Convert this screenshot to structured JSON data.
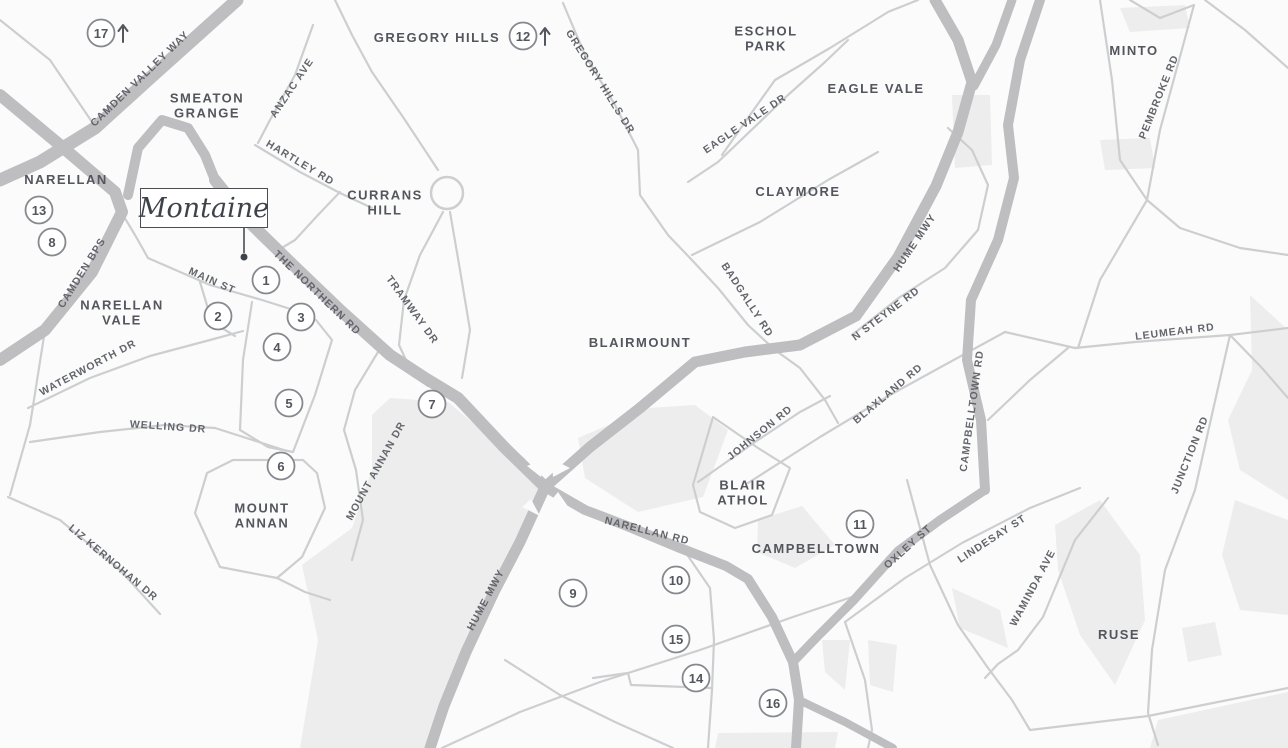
{
  "colors": {
    "bg": "#fbfbfb",
    "area": "#ededee",
    "road_thin": "#cdced0",
    "road_thick": "#bebec1",
    "suburb_label": "#54565e",
    "road_label": "#63656c",
    "marker_stroke": "#86888e",
    "marker_text": "#54565e",
    "montaine_border": "#4a4d54",
    "montaine_text": "#3e424b"
  },
  "montaine": {
    "label": "Montaine",
    "box": {
      "x": 140,
      "y": 188,
      "w": 128,
      "h": 40
    },
    "leader": {
      "x1": 244,
      "y1": 228,
      "x2": 244,
      "y2": 253
    },
    "dot": {
      "x": 244,
      "y": 257
    }
  },
  "suburbs": [
    {
      "name": "gregory-hills",
      "lines": [
        "GREGORY HILLS"
      ],
      "x": 437,
      "y": 42
    },
    {
      "name": "smeaton-grange",
      "lines": [
        "SMEATON",
        "GRANGE"
      ],
      "x": 207,
      "y": 110
    },
    {
      "name": "narellan",
      "lines": [
        "NARELLAN"
      ],
      "x": 66,
      "y": 184
    },
    {
      "name": "narellan-vale",
      "lines": [
        "NARELLAN",
        "VALE"
      ],
      "x": 122,
      "y": 317
    },
    {
      "name": "currans-hill",
      "lines": [
        "CURRANS",
        "HILL"
      ],
      "x": 385,
      "y": 207
    },
    {
      "name": "mount-annan",
      "lines": [
        "MOUNT",
        "ANNAN"
      ],
      "x": 262,
      "y": 520
    },
    {
      "name": "blairmount",
      "lines": [
        "BLAIRMOUNT"
      ],
      "x": 640,
      "y": 347
    },
    {
      "name": "eschol-park",
      "lines": [
        "ESCHOL",
        "PARK"
      ],
      "x": 766,
      "y": 43
    },
    {
      "name": "eagle-vale",
      "lines": [
        "EAGLE VALE"
      ],
      "x": 876,
      "y": 93
    },
    {
      "name": "claymore",
      "lines": [
        "CLAYMORE"
      ],
      "x": 798,
      "y": 196
    },
    {
      "name": "minto",
      "lines": [
        "MINTO"
      ],
      "x": 1134,
      "y": 55
    },
    {
      "name": "blair-athol",
      "lines": [
        "BLAIR",
        "ATHOL"
      ],
      "x": 743,
      "y": 497
    },
    {
      "name": "campbelltown",
      "lines": [
        "CAMPBELLTOWN"
      ],
      "x": 816,
      "y": 553
    },
    {
      "name": "ruse",
      "lines": [
        "RUSE"
      ],
      "x": 1119,
      "y": 639
    }
  ],
  "road_labels": [
    {
      "name": "camden-valley-way",
      "label": "CAMDEN VALLEY WAY",
      "x": 140,
      "y": 79,
      "rotate": -44
    },
    {
      "name": "camden-bps",
      "label": "CAMDEN BPS",
      "x": 82,
      "y": 273,
      "rotate": -58
    },
    {
      "name": "anzac-ave",
      "label": "ANZAC AVE",
      "x": 292,
      "y": 88,
      "rotate": -56
    },
    {
      "name": "hartley-rd",
      "label": "HARTLEY RD",
      "x": 300,
      "y": 163,
      "rotate": 31
    },
    {
      "name": "main-st",
      "label": "MAIN ST",
      "x": 212,
      "y": 281,
      "rotate": 24
    },
    {
      "name": "the-northern-rd",
      "label": "THE NORTHERN RD",
      "x": 317,
      "y": 293,
      "rotate": 44
    },
    {
      "name": "tramway-dr",
      "label": "TRAMWAY DR",
      "x": 412,
      "y": 310,
      "rotate": 54
    },
    {
      "name": "mount-annan-dr",
      "label": "MOUNT ANNAN DR",
      "x": 376,
      "y": 471,
      "rotate": -61
    },
    {
      "name": "waterworth-dr",
      "label": "WATERWORTH DR",
      "x": 88,
      "y": 368,
      "rotate": -28
    },
    {
      "name": "welling-dr",
      "label": "WELLING DR",
      "x": 168,
      "y": 427,
      "rotate": 4
    },
    {
      "name": "liz-kernohan-dr",
      "label": "LIZ KERNOHAN DR",
      "x": 113,
      "y": 563,
      "rotate": 40
    },
    {
      "name": "gregory-hills-dr",
      "label": "GREGORY HILLS DR",
      "x": 600,
      "y": 82,
      "rotate": 58
    },
    {
      "name": "eagle-vale-dr",
      "label": "EAGLE VALE DR",
      "x": 745,
      "y": 124,
      "rotate": -34
    },
    {
      "name": "hume-mwy-north",
      "label": "HUME MWY",
      "x": 915,
      "y": 243,
      "rotate": -56
    },
    {
      "name": "hume-mwy-south",
      "label": "HUME MWY",
      "x": 486,
      "y": 600,
      "rotate": -62
    },
    {
      "name": "pembroke-rd",
      "label": "PEMBROKE RD",
      "x": 1159,
      "y": 97,
      "rotate": -68
    },
    {
      "name": "badgally-rd",
      "label": "BADGALLY RD",
      "x": 747,
      "y": 300,
      "rotate": 57
    },
    {
      "name": "n-steyne-rd",
      "label": "N STEYNE RD",
      "x": 886,
      "y": 314,
      "rotate": -37
    },
    {
      "name": "blaxland-rd",
      "label": "BLAXLAND RD",
      "x": 888,
      "y": 394,
      "rotate": -40
    },
    {
      "name": "campbelltown-rd",
      "label": "CAMPBELLTOWN RD",
      "x": 972,
      "y": 411,
      "rotate": -82
    },
    {
      "name": "johnson-rd",
      "label": "JOHNSON RD",
      "x": 760,
      "y": 433,
      "rotate": -39
    },
    {
      "name": "narellan-rd",
      "label": "NARELLAN RD",
      "x": 647,
      "y": 531,
      "rotate": 14
    },
    {
      "name": "oxley-st",
      "label": "OXLEY ST",
      "x": 908,
      "y": 547,
      "rotate": -42
    },
    {
      "name": "lindesay-st",
      "label": "LINDESAY ST",
      "x": 992,
      "y": 539,
      "rotate": -33
    },
    {
      "name": "waminda-ave",
      "label": "WAMINDA AVE",
      "x": 1033,
      "y": 588,
      "rotate": -62
    },
    {
      "name": "junction-rd",
      "label": "JUNCTION RD",
      "x": 1190,
      "y": 455,
      "rotate": -68
    },
    {
      "name": "leumeah-rd",
      "label": "LEUMEAH RD",
      "x": 1175,
      "y": 332,
      "rotate": -7
    }
  ],
  "markers": [
    {
      "n": "1",
      "x": 266,
      "y": 280
    },
    {
      "n": "2",
      "x": 218,
      "y": 316
    },
    {
      "n": "3",
      "x": 301,
      "y": 317
    },
    {
      "n": "4",
      "x": 277,
      "y": 347
    },
    {
      "n": "5",
      "x": 289,
      "y": 403
    },
    {
      "n": "6",
      "x": 281,
      "y": 466
    },
    {
      "n": "7",
      "x": 432,
      "y": 404
    },
    {
      "n": "8",
      "x": 52,
      "y": 242
    },
    {
      "n": "9",
      "x": 573,
      "y": 593
    },
    {
      "n": "10",
      "x": 676,
      "y": 580
    },
    {
      "n": "11",
      "x": 860,
      "y": 524
    },
    {
      "n": "12",
      "x": 523,
      "y": 36,
      "arrow": true
    },
    {
      "n": "13",
      "x": 39,
      "y": 210
    },
    {
      "n": "14",
      "x": 696,
      "y": 678
    },
    {
      "n": "15",
      "x": 676,
      "y": 639
    },
    {
      "n": "16",
      "x": 773,
      "y": 703
    },
    {
      "n": "17",
      "x": 101,
      "y": 33,
      "arrow": true
    }
  ]
}
